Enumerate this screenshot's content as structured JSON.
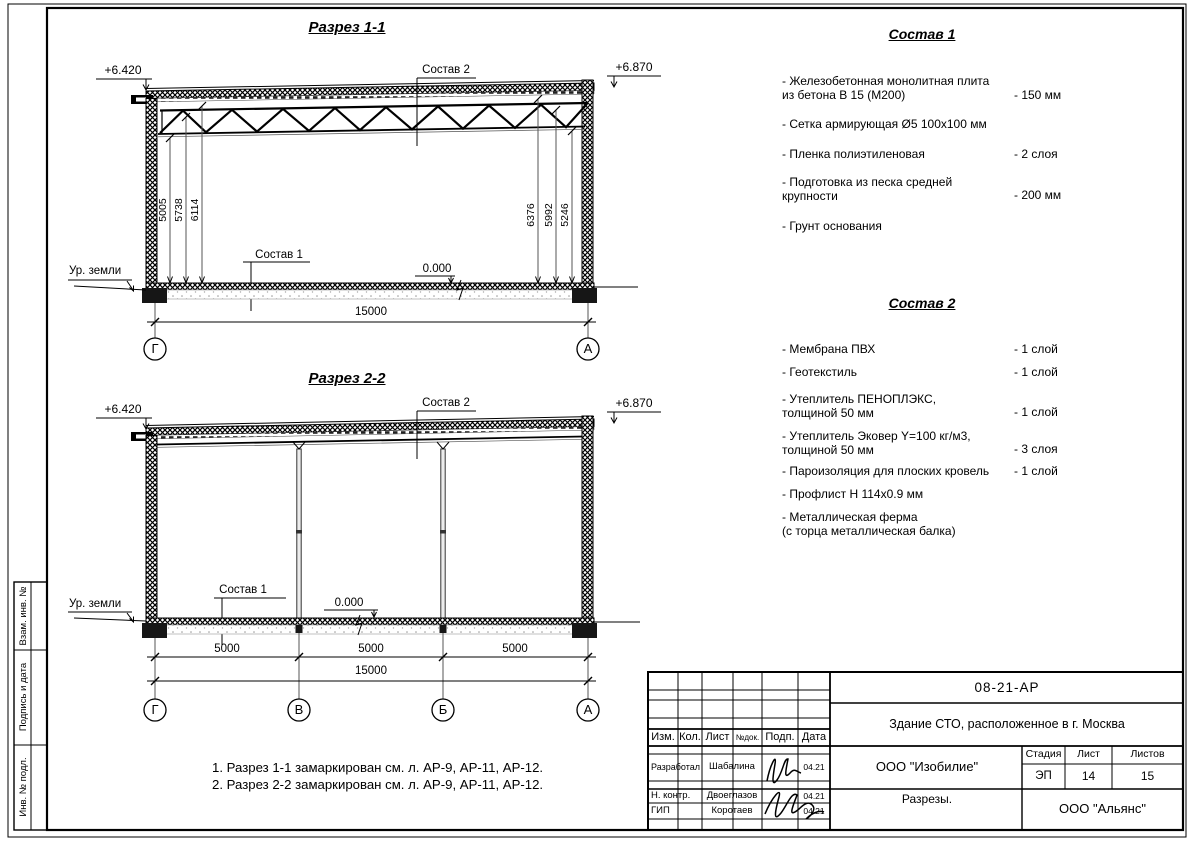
{
  "s1": {
    "title": "Разрез 1-1",
    "elev_left": "+6.420",
    "elev_right": "+6.870",
    "sostav2": "Состав 2",
    "sostav1": "Состав 1",
    "zero": "0.000",
    "ground": "Ур. земли",
    "dimL1": "5005",
    "dimL2": "5738",
    "dimL3": "6114",
    "dimR1": "6376",
    "dimR2": "5992",
    "dimR3": "5246",
    "total": "15000",
    "axis_left": "Г",
    "axis_right": "А"
  },
  "s2": {
    "title": "Разрез 2-2",
    "elev_left": "+6.420",
    "elev_right": "+6.870",
    "sostav2": "Состав 2",
    "sostav1": "Состав 1",
    "zero": "0.000",
    "ground": "Ур. земли",
    "span1": "5000",
    "span2": "5000",
    "span3": "5000",
    "total": "15000",
    "axis1": "Г",
    "axis2": "В",
    "axis3": "Б",
    "axis4": "А"
  },
  "c1": {
    "title": "Состав 1",
    "items": [
      {
        "name": "- Железобетонная  монолитная плита\nиз бетона В 15 (М200)",
        "value": "- 150 мм"
      },
      {
        "name": "- Сетка армирующая Ø5 100х100 мм",
        "value": ""
      },
      {
        "name": "- Пленка полиэтиленовая",
        "value": "-  2 слоя"
      },
      {
        "name": "- Подготовка из песка средней\nкрупности",
        "value": "- 200 мм"
      },
      {
        "name": "- Грунт основания",
        "value": ""
      }
    ]
  },
  "c2": {
    "title": "Состав 2",
    "items": [
      {
        "name": "- Мембрана ПВХ",
        "value": "- 1 слой"
      },
      {
        "name": "- Геотекстиль",
        "value": "- 1 слой"
      },
      {
        "name": "- Утеплитель ПЕНОПЛЭКС,\nтолщиной 50 мм",
        "value": "- 1 слой"
      },
      {
        "name": "- Утеплитель Эковер Y=100 кг/м3,\nтолщиной 50 мм",
        "value": "- 3 слоя"
      },
      {
        "name": "- Пароизоляция для плоских кровель",
        "value": "- 1 слой"
      },
      {
        "name": "- Профлист Н 114х0.9 мм",
        "value": ""
      },
      {
        "name": "- Металлическая ферма\n(с торца металлическая балка)",
        "value": ""
      }
    ]
  },
  "notes": {
    "line1": "1. Разрез 1-1 замаркирован см. л. АР-9, АР-11, АР-12.",
    "line2": "2. Разрез 2-2 замаркирован см. л. АР-9, АР-11, АР-12."
  },
  "frame": {
    "v1": "Взам. инв. №",
    "v2": "Подпись и дата",
    "v3": "Инв. № подл."
  },
  "stamp": {
    "doc": "08-21-АР",
    "object": "Здание СТО, расположенное в г. Москва",
    "h_izm": "Изм.",
    "h_kol": "Кол.",
    "h_list": "Лист",
    "h_doc": "№док.",
    "h_podp": "Подп.",
    "h_data": "Дата",
    "r1_role": "Разработал",
    "r1_name": "Шабалина",
    "r1_date": "04.21",
    "r2_role": "Н. контр.",
    "r2_name": "Двоеглазов",
    "r2_date": "04.21",
    "r3_role": "ГИП",
    "r3_name": "Коротаев",
    "r3_date": "04.21",
    "company": "ООО \"Изобилие\"",
    "sheet_name": "Разрезы.",
    "stage_h": "Стадия",
    "list_h": "Лист",
    "listov_h": "Листов",
    "stage": "ЭП",
    "list": "14",
    "listov": "15",
    "contractor": "ООО \"Альянс\""
  }
}
